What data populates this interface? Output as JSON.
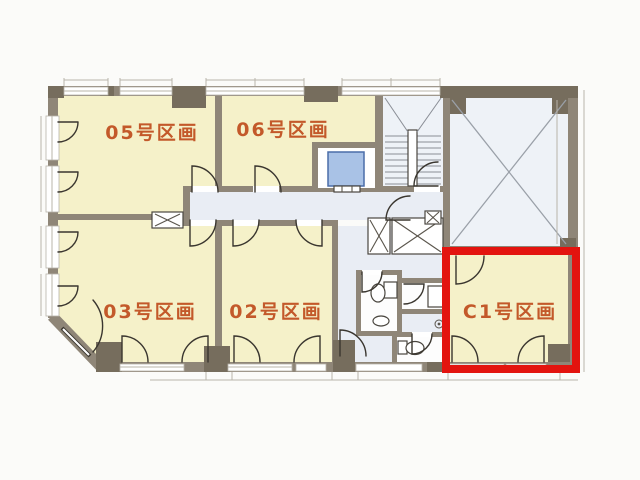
{
  "rooms": [
    {
      "label": "05号区画",
      "highlighted": false
    },
    {
      "label": "06号区画",
      "highlighted": false
    },
    {
      "label": "03号区画",
      "highlighted": false
    },
    {
      "label": "02号区画",
      "highlighted": false
    },
    {
      "label": "C1号区画",
      "highlighted": true
    }
  ],
  "icons": {
    "elevator": "elevator-car",
    "staircase": "stair-treads",
    "toilet": "toilet-fixture",
    "shaft": "x-cross-shaft",
    "void": "x-cross-void",
    "door": "door-swing-arc"
  },
  "colors": {
    "room_fill": "#f5f1c9",
    "common_fill": "#e9edf4",
    "void_fill": "#eef2f7",
    "wall": "#8f8678",
    "pier": "#766d5d",
    "elevator_fill": "#a9c2e6",
    "highlight": "#e3140f",
    "label_text": "#c3592a"
  }
}
